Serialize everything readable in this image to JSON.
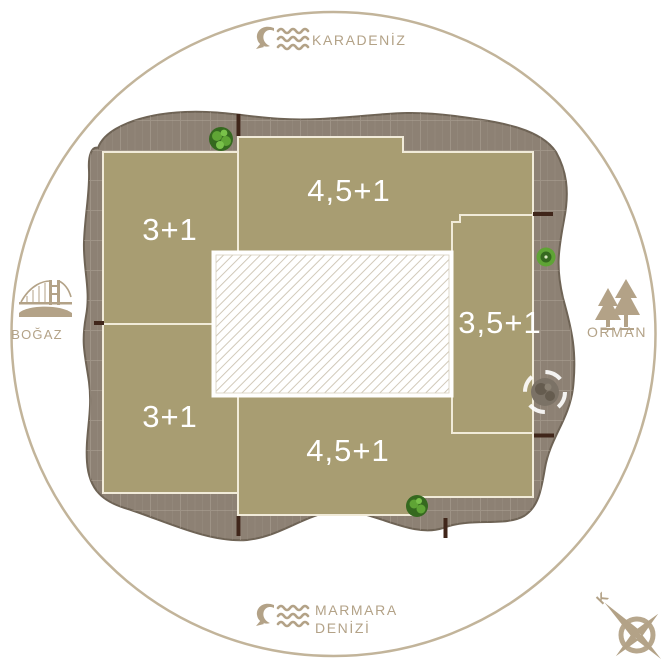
{
  "plan": {
    "units": [
      {
        "id": "unit-top",
        "label": "4,5+1"
      },
      {
        "id": "unit-upper-left",
        "label": "3+1"
      },
      {
        "id": "unit-right",
        "label": "3,5+1"
      },
      {
        "id": "unit-lower-left",
        "label": "3+1"
      },
      {
        "id": "unit-bottom",
        "label": "4,5+1"
      }
    ]
  },
  "landmarks": {
    "north": {
      "label": "KARADENİZ",
      "icon": "sea-waves-icon"
    },
    "south": {
      "label_line1": "MARMARA",
      "label_line2": "DENİZİ",
      "icon": "sea-waves-icon"
    },
    "west": {
      "label": "BOĞAZ",
      "icon": "bridge-icon"
    },
    "east": {
      "label": "ORMAN",
      "icon": "forest-icon"
    }
  },
  "compass": {
    "north_label": "K",
    "icon": "compass-rose-icon"
  },
  "colors": {
    "accent": "#b3a287",
    "ring": "#c2b49a",
    "terrace": "#8d8174",
    "terrace_line": "#b3a89a",
    "outline": "#6e6355",
    "unit": "#a89d72",
    "unit_border": "#f1ebd9",
    "hatch": "#ccc3b1",
    "tick": "#40261a",
    "unit_label": "#ffffff",
    "bush": "#5fa435",
    "bush_dark": "#35691f",
    "gray_tree": "#7b7266",
    "gray_tree_dark": "#655c4f"
  }
}
